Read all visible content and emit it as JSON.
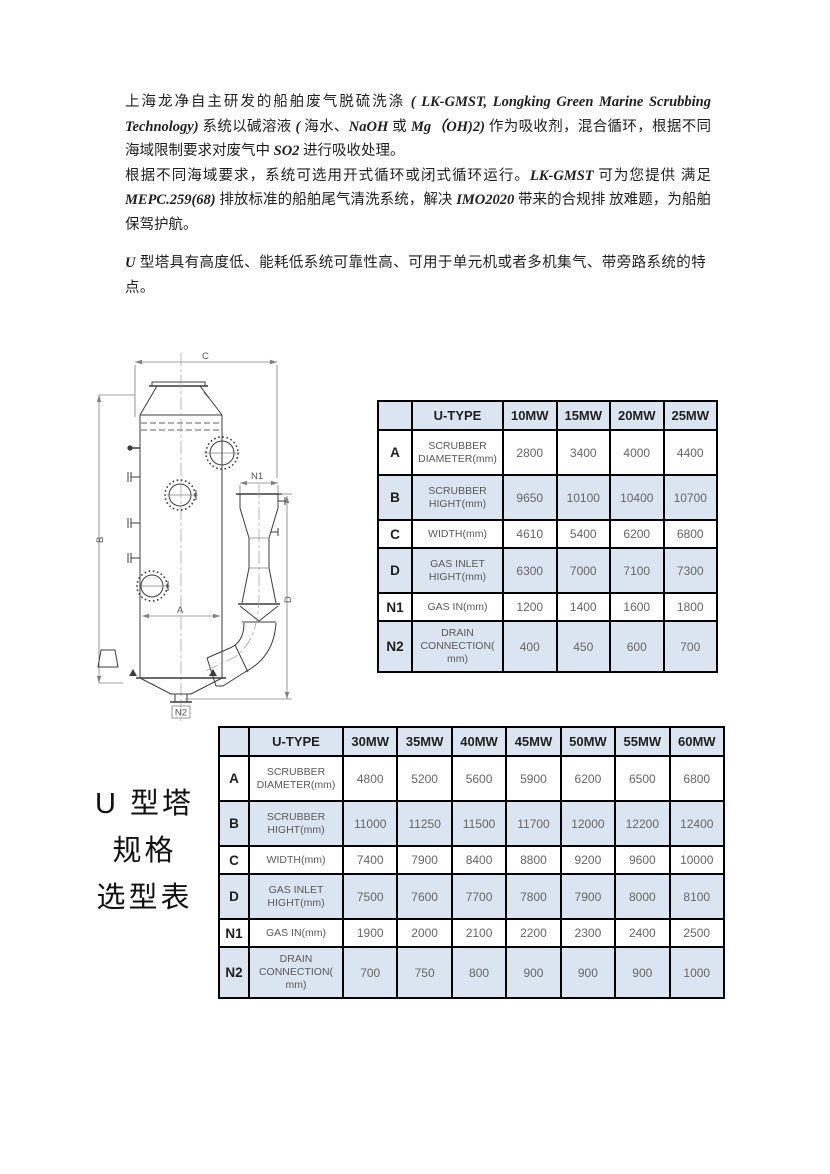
{
  "doc": {
    "para1": [
      {
        "s": "cn",
        "t": "上海龙净自主研发的船舶废气脱硫洗涤 "
      },
      {
        "s": "lat",
        "t": "( LK-GMST, Longking Green Marine Scrubbing Technology) "
      },
      {
        "s": "cn",
        "t": "系统以碱溶液 "
      },
      {
        "s": "lat",
        "t": "( "
      },
      {
        "s": "cn",
        "t": "海水、"
      },
      {
        "s": "lat",
        "t": "NaOH "
      },
      {
        "s": "cn",
        "t": "或 "
      },
      {
        "s": "lat",
        "t": "Mg（OH)2) "
      },
      {
        "s": "cn",
        "t": "作为吸收剂，混合循环，根据不同海域限制要求对废气中 "
      },
      {
        "s": "lat",
        "t": "SO2 "
      },
      {
        "s": "cn",
        "t": "进行吸收处理。"
      }
    ],
    "para2": [
      {
        "s": "cn",
        "t": "根据不同海域要求，系统可选用开式循环或闭式循环运行。"
      },
      {
        "s": "lat",
        "t": "LK-GMST "
      },
      {
        "s": "cn",
        "t": "可为您提供 满足 "
      },
      {
        "s": "lat",
        "t": "MEPC.259(68) "
      },
      {
        "s": "cn",
        "t": "排放标准的船舶尾气清洗系统，解决 "
      },
      {
        "s": "lat",
        "t": "IMO2020 "
      },
      {
        "s": "cn",
        "t": "带来的合规排 放难题，为船舶保驾护航。"
      }
    ],
    "para3": [
      {
        "s": "lat",
        "t": "U "
      },
      {
        "s": "cn",
        "t": "型塔具有高度低、能耗低系统可靠性高、可用于单元机或者多机集气、带旁路系统的特点。"
      }
    ]
  },
  "side_label": {
    "lines": [
      "U 型塔",
      "规格",
      "选型表"
    ]
  },
  "diagram": {
    "labels": {
      "c": "C",
      "b": "B",
      "a": "A",
      "d": "D",
      "n1": "N1",
      "n2": "N2"
    }
  },
  "tables": [
    {
      "name": "U-type scrubber sizing 10-25MW",
      "headers": [
        "",
        "U-TYPE",
        "10MW",
        "15MW",
        "20MW",
        "25MW"
      ],
      "rows": [
        {
          "key": "A",
          "label_lines": [
            "SCRUBBER",
            "DIAMETER(mm)"
          ],
          "values": [
            "2800",
            "3400",
            "4000",
            "4400"
          ]
        },
        {
          "key": "B",
          "label_lines": [
            "SCRUBBER",
            "HIGHT(mm)"
          ],
          "values": [
            "9650",
            "10100",
            "10400",
            "10700"
          ]
        },
        {
          "key": "C",
          "label_lines": [
            "WIDTH(mm)"
          ],
          "values": [
            "4610",
            "5400",
            "6200",
            "6800"
          ]
        },
        {
          "key": "D",
          "label_lines": [
            "GAS INLET",
            "HIGHT(mm)"
          ],
          "values": [
            "6300",
            "7000",
            "7100",
            "7300"
          ]
        },
        {
          "key": "N1",
          "label_lines": [
            "GAS IN(mm)"
          ],
          "values": [
            "1200",
            "1400",
            "1600",
            "1800"
          ]
        },
        {
          "key": "N2",
          "label_lines": [
            "DRAIN",
            "CONNECTION(",
            "mm)"
          ],
          "values": [
            "400",
            "450",
            "600",
            "700"
          ]
        }
      ]
    },
    {
      "name": "U-type scrubber sizing 30-60MW",
      "headers": [
        "",
        "U-TYPE",
        "30MW",
        "35MW",
        "40MW",
        "45MW",
        "50MW",
        "55MW",
        "60MW"
      ],
      "rows": [
        {
          "key": "A",
          "label_lines": [
            "SCRUBBER",
            "DIAMETER(mm)"
          ],
          "values": [
            "4800",
            "5200",
            "5600",
            "5900",
            "6200",
            "6500",
            "6800"
          ]
        },
        {
          "key": "B",
          "label_lines": [
            "SCRUBBER",
            "HIGHT(mm)"
          ],
          "values": [
            "11000",
            "11250",
            "11500",
            "11700",
            "12000",
            "12200",
            "12400"
          ]
        },
        {
          "key": "C",
          "label_lines": [
            "WIDTH(mm)"
          ],
          "values": [
            "7400",
            "7900",
            "8400",
            "8800",
            "9200",
            "9600",
            "10000"
          ]
        },
        {
          "key": "D",
          "label_lines": [
            "GAS INLET",
            "HIGHT(mm)"
          ],
          "values": [
            "7500",
            "7600",
            "7700",
            "7800",
            "7900",
            "8000",
            "8100"
          ]
        },
        {
          "key": "N1",
          "label_lines": [
            "GAS IN(mm)"
          ],
          "values": [
            "1900",
            "2000",
            "2100",
            "2200",
            "2300",
            "2400",
            "2500"
          ]
        },
        {
          "key": "N2",
          "label_lines": [
            "DRAIN",
            "CONNECTION(",
            "mm)"
          ],
          "values": [
            "700",
            "750",
            "800",
            "900",
            "900",
            "900",
            "1000"
          ]
        }
      ]
    }
  ],
  "colors": {
    "table_header_fill": "#dbe5f1",
    "table_border": "#000000",
    "value_text": "#595959",
    "body_text": "#1f1f1f"
  }
}
